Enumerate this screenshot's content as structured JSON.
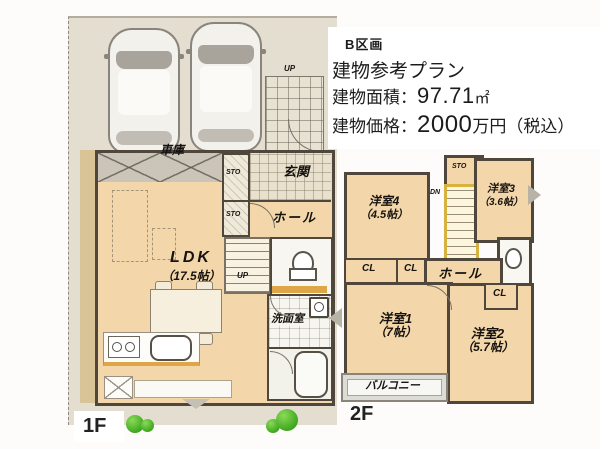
{
  "info_box": {
    "section_label": "B区画",
    "plan_title": "建物参考プラン",
    "area_label": "建物面積：",
    "area_value": "97.71",
    "area_unit": "㎡",
    "price_label": "建物価格：",
    "price_value": "2000",
    "price_note": "万円（税込）"
  },
  "floor_1f": {
    "name": "1F",
    "garage_label": "車庫",
    "entrance_label": "玄関",
    "storage1_label": "STO",
    "storage2_label": "STO",
    "hall_label": "ホール",
    "ldk_label": "LDK",
    "ldk_size": "（17.5帖）",
    "washroom_label": "洗面室",
    "stairs_label": "UP",
    "porch_label": "UP"
  },
  "floor_2f": {
    "name": "2F",
    "room1_label": "洋室1",
    "room1_size": "（7帖）",
    "room2_label": "洋室2",
    "room2_size": "（5.7帖）",
    "room3_label": "洋室3",
    "room3_size": "（3.6帖）",
    "room4_label": "洋室4",
    "room4_size": "（4.5帖）",
    "hall_label": "ホール",
    "storage_label": "STO",
    "stairs_label": "DN",
    "balcony_label": "バルコニー",
    "closet1_label": "CL",
    "closet2_label": "CL",
    "closet3_label": "CL"
  },
  "colors": {
    "site": "#e4ded1",
    "floor": "#f3d7aa",
    "wall": "#4f463c",
    "stair": "#d8b23e",
    "counter": "#dfa648"
  }
}
